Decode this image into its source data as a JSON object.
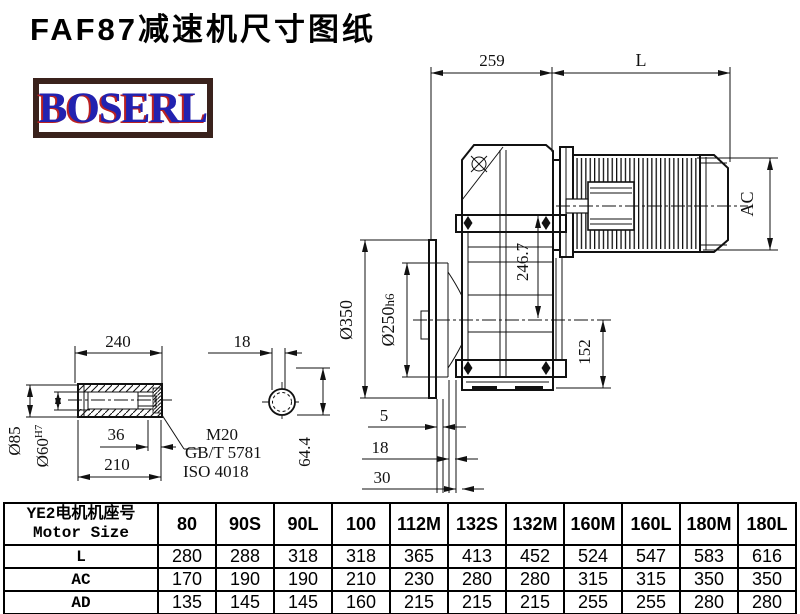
{
  "title": "FAF87减速机尺寸图纸",
  "logo": {
    "text": "BOSERL"
  },
  "colors": {
    "line": "#111111",
    "logo_border": "#3a221c",
    "logo_text": "#2222b0",
    "logo_shadow": "#bb2222"
  },
  "dims": {
    "top_width": "259",
    "motor_length": "L",
    "motor_diameter": "AC",
    "center_height": "246.7",
    "flange_to_base": "152",
    "flange_od": "Ø350",
    "spigot_base": "Ø250",
    "spigot_tol": "h6",
    "offset1": "5",
    "offset2": "18",
    "offset3": "30",
    "shaft_length": "240",
    "shaft_od": "Ø85",
    "bore_base": "Ø60",
    "bore_tol": "H7",
    "thread_depth": "36",
    "hub_length": "210",
    "thread": "M20",
    "standard1": "GB/T 5781",
    "standard2": "ISO 4018",
    "key_width": "18",
    "key_height": "64.4"
  },
  "table": {
    "header": {
      "line1": "YE2电机机座号",
      "line2": "Motor Size"
    },
    "columns": [
      "80",
      "90S",
      "90L",
      "100",
      "112M",
      "132S",
      "132M",
      "160M",
      "160L",
      "180M",
      "180L"
    ],
    "rows": [
      {
        "label": "L",
        "values": [
          "280",
          "288",
          "318",
          "318",
          "365",
          "413",
          "452",
          "524",
          "547",
          "583",
          "616"
        ]
      },
      {
        "label": "AC",
        "values": [
          "170",
          "190",
          "190",
          "210",
          "230",
          "280",
          "280",
          "315",
          "315",
          "350",
          "350"
        ]
      },
      {
        "label": "AD",
        "values": [
          "135",
          "145",
          "145",
          "160",
          "215",
          "215",
          "215",
          "255",
          "255",
          "280",
          "280"
        ]
      }
    ]
  }
}
